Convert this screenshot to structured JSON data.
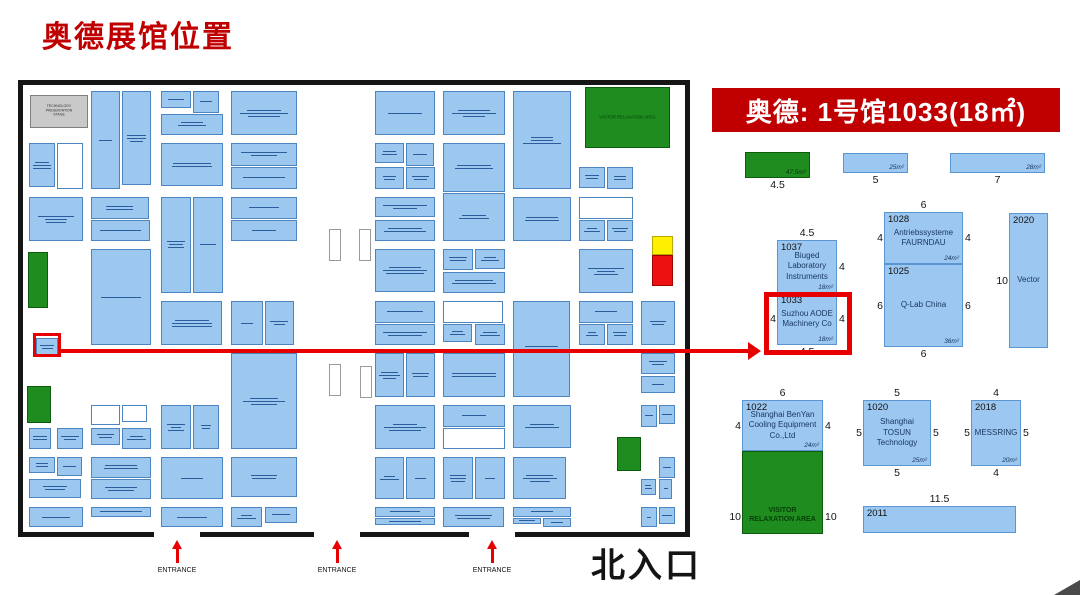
{
  "page": {
    "title": "奥德展馆位置"
  },
  "map": {
    "stage_label": "TECHNOLOGY PRESENTATION STAGE",
    "relaxation_label": "VISITOR RELAXATION AREA",
    "entrance_labels": [
      "ENTRANCE",
      "ENTRANCE",
      "ENTRANCE"
    ],
    "north_entrance_label": "北入口"
  },
  "detail_panel": {
    "header": "奥德: 1号馆1033(18㎡)",
    "booths": [
      {
        "id": "green-top",
        "type": "green",
        "x": 745,
        "y": 152,
        "w": 65,
        "h": 26,
        "area": "47.5m²",
        "dims": {
          "bottom": "4.5"
        }
      },
      {
        "id": "strip-25",
        "type": "blue",
        "x": 843,
        "y": 153,
        "w": 65,
        "h": 20,
        "area": "25m²",
        "dims": {
          "bottom": "5"
        }
      },
      {
        "id": "strip-28",
        "type": "blue",
        "x": 950,
        "y": 153,
        "w": 95,
        "h": 20,
        "area": "28m²",
        "dims": {
          "bottom": "7"
        }
      },
      {
        "id": "1037",
        "number": "1037",
        "type": "blue",
        "x": 777,
        "y": 240,
        "w": 60,
        "h": 53,
        "name": "Biuged Laboratory Instruments",
        "area": "18m²",
        "dims": {
          "top": "4.5",
          "right": "4"
        }
      },
      {
        "id": "1033",
        "number": "1033",
        "type": "blue",
        "x": 777,
        "y": 293,
        "w": 60,
        "h": 52,
        "name": "Suzhou AODE Machinery Co",
        "area": "18m²",
        "dims": {
          "left": "4",
          "right": "4",
          "bottom": "4.5"
        },
        "highlight": true
      },
      {
        "id": "1028",
        "number": "1028",
        "type": "blue",
        "x": 884,
        "y": 212,
        "w": 79,
        "h": 52,
        "name": "Antriebssysteme FAURNDAU",
        "area": "24m²",
        "dims": {
          "top": "6",
          "left": "4",
          "right": "4"
        }
      },
      {
        "id": "1025",
        "number": "1025",
        "type": "blue",
        "x": 884,
        "y": 264,
        "w": 79,
        "h": 83,
        "name": "Q-Lab China",
        "area": "36m²",
        "dims": {
          "left": "6",
          "right": "6",
          "bottom": "6"
        }
      },
      {
        "id": "2020",
        "number": "2020",
        "type": "blue",
        "x": 1009,
        "y": 213,
        "w": 39,
        "h": 135,
        "name": "Vector",
        "dims": {
          "left": "10"
        }
      },
      {
        "id": "1022",
        "number": "1022",
        "type": "blue",
        "x": 742,
        "y": 400,
        "w": 81,
        "h": 51,
        "name": "Shanghai BenYan Cooling Equipment Co.,Ltd",
        "area": "24m²",
        "dims": {
          "top": "6",
          "left": "4",
          "right": "4"
        }
      },
      {
        "id": "visitor-area",
        "type": "green",
        "x": 742,
        "y": 451,
        "w": 81,
        "h": 83,
        "name": "VISITOR RELAXATION AREA",
        "dims": {
          "left": "10",
          "right": "10"
        },
        "dims_v": "bottom",
        "name_pos": "bottom"
      },
      {
        "id": "1020",
        "number": "1020",
        "type": "blue",
        "x": 863,
        "y": 400,
        "w": 68,
        "h": 66,
        "name": "Shanghai TOSUN Technology",
        "area": "25m²",
        "dims": {
          "top": "5",
          "left": "5",
          "right": "5",
          "bottom": "5"
        }
      },
      {
        "id": "2018",
        "number": "2018",
        "type": "blue",
        "x": 971,
        "y": 400,
        "w": 50,
        "h": 66,
        "name": "MESSRING",
        "area": "20m²",
        "dims": {
          "top": "4",
          "left": "5",
          "right": "5",
          "bottom": "4"
        }
      },
      {
        "id": "2011",
        "number": "2011",
        "type": "blue",
        "x": 863,
        "y": 506,
        "w": 153,
        "h": 27,
        "dims": {
          "top": "11.5"
        }
      }
    ]
  },
  "colors": {
    "brand_red": "#C00000",
    "booth_blue": "#9CC7EF",
    "booth_border": "#4C85BF",
    "detail_blue": "#9CC7F0",
    "green": "#1E8C1E",
    "yellow": "#FFEF00",
    "marker_red": "#EE1111",
    "highlight_red": "#E60000",
    "arrow_red": "#E60000"
  }
}
